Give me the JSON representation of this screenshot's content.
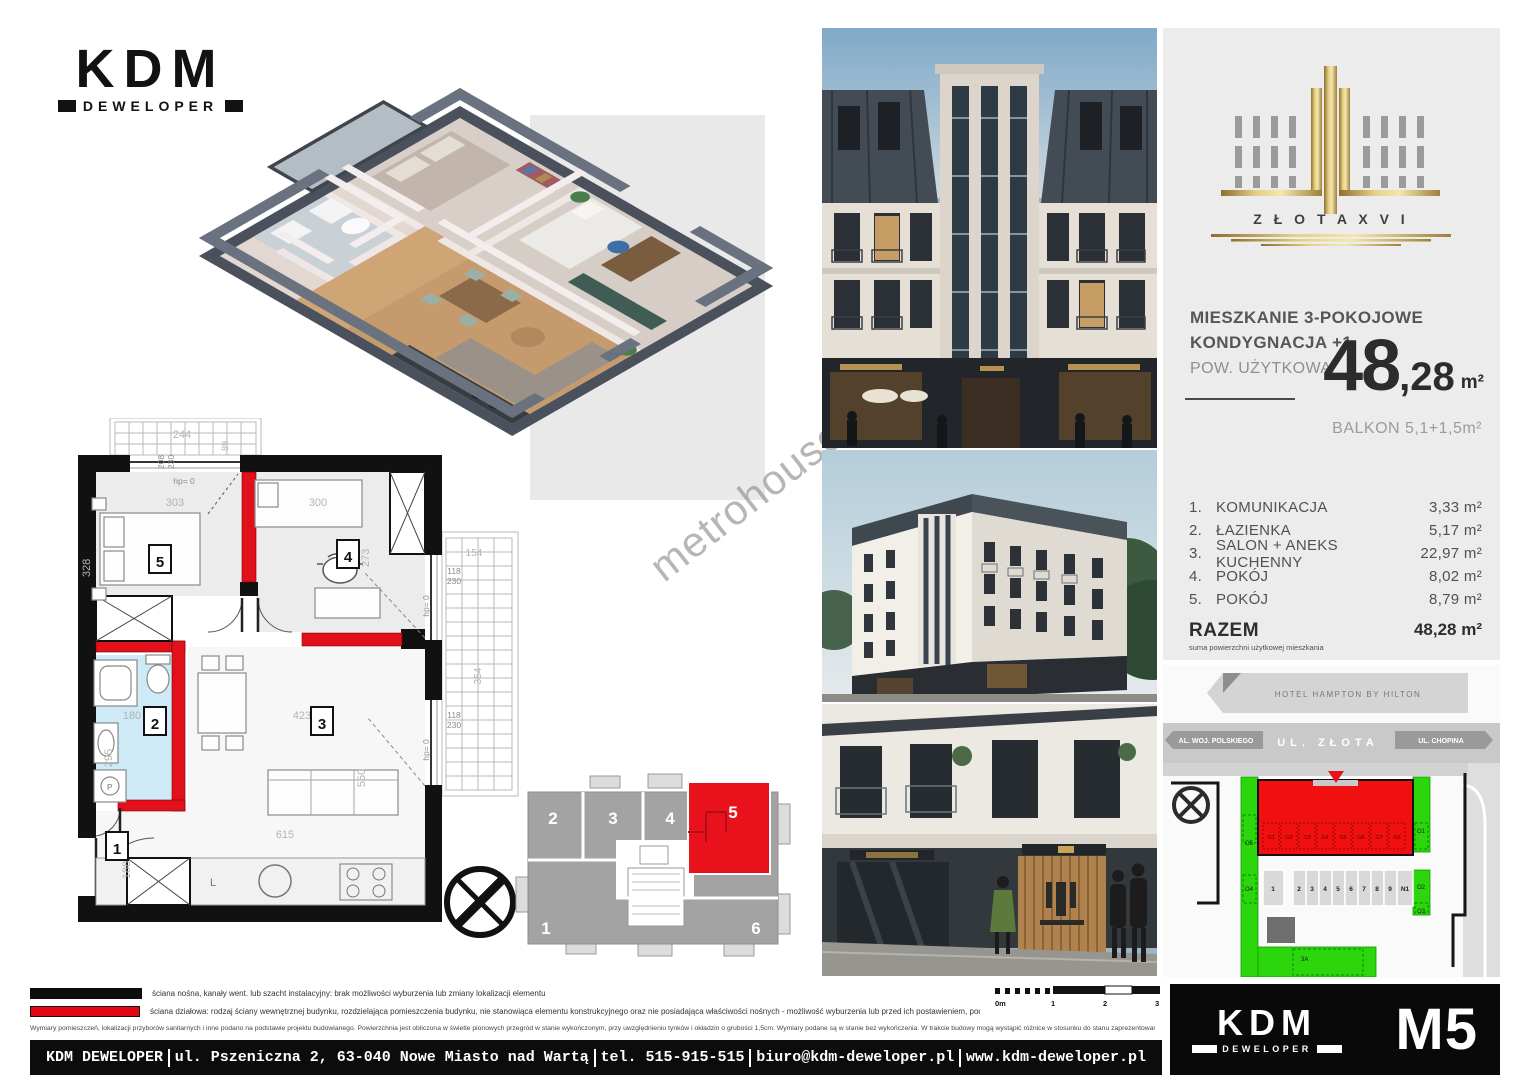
{
  "brand": {
    "logo_text": "KDM",
    "logo_sub": "DEWELOPER"
  },
  "watermark": "metrohouse",
  "project": {
    "name": "Z Ł O T A  X V I"
  },
  "unit": {
    "type_line1": "MIESZKANIE 3-POKOJOWE",
    "type_line2": "KONDYGNACJA +1",
    "area_label": "POW. UŻYTKOWA",
    "area_int": "48",
    "area_dec": ",28",
    "area_unit": "m²",
    "balcony": "BALKON 5,1+1,5m²",
    "rooms": [
      {
        "no": "1.",
        "name": "KOMUNIKACJA",
        "area": "3,33 m²"
      },
      {
        "no": "2.",
        "name": "ŁAZIENKA",
        "area": "5,17 m²"
      },
      {
        "no": "3.",
        "name": "SALON + ANEKS KUCHENNY",
        "area": "22,97 m²"
      },
      {
        "no": "4.",
        "name": "POKÓJ",
        "area": "8,02 m²"
      },
      {
        "no": "5.",
        "name": "POKÓJ",
        "area": "8,79 m²"
      }
    ],
    "total_label": "RAZEM",
    "total_sub": "suma powierzchni użytkowej mieszkania",
    "total_area": "48,28 m²",
    "unit_code": "M5"
  },
  "floorplan": {
    "room_numbers": [
      "1",
      "2",
      "3",
      "4",
      "5"
    ],
    "dims": {
      "room5_w": "303",
      "room5_h": "328",
      "room4_w": "300",
      "room4_h": "273",
      "bath_w": "180",
      "bath_h": "295",
      "salon_w": "423",
      "salon_h": "550",
      "bottom": "615",
      "hall_h": "188",
      "balcony_w": "244",
      "balcony_d": "89",
      "win_top_a": "208",
      "win_top_b": "230",
      "win_r1a": "118",
      "win_r1b": "230",
      "win_r2a": "118",
      "win_r2b": "230",
      "balc_r_w": "154",
      "balc_r_h": "354",
      "hp": "hp= 0",
      "l_label": "L"
    }
  },
  "keyplan": {
    "units": [
      "1",
      "2",
      "3",
      "4",
      "5",
      "6"
    ]
  },
  "sitemap": {
    "hotel": "HOTEL HAMPTON BY HILTON",
    "street_left": "AL. WOJ. POLSKIEGO",
    "street_center": "UL. ZŁOTA",
    "street_right": "UL. CHOPINA",
    "garages": [
      "G1",
      "G2",
      "G3",
      "G4",
      "G5",
      "G6",
      "G7",
      "G8"
    ],
    "parking": [
      "1",
      "2",
      "3",
      "4",
      "5",
      "6",
      "7",
      "8",
      "9",
      "N1"
    ],
    "labels": {
      "o1": "O1",
      "o2": "O2",
      "o3": "O3",
      "o4": "O4",
      "o5": "O5",
      "a3": "3A"
    }
  },
  "legend": {
    "line1": "ściana nośna, kanały went. lub szacht instalacyjny: brak możliwości wyburzenia lub zmiany lokalizacji elementu",
    "line2": "ściana działowa: rodzaj ściany wewnętrznej budynku, rozdzielająca pomieszczenia budynku, nie stanowiąca elementu konstrukcyjnego oraz nie posiadająca właściwości nośnych - możliwość wyburzenia lub przed ich postawieniem, podania własnych preferencji dotyczących lokalizacji elementu",
    "disclaimer": "Wymiary pomieszczeń, lokalizacji przyborów sanitarnych i inne podano na podstawie projektu budowlanego. Powierzchnia jest obliczona w świetle pionowych przegród w stanie wykończonym, przy uwzględnieniu tynków i okładzin o grubości 1,5cm. Wymiary podane są w stanie bez wykończenia. W trakcie budowy mogą wystąpić różnice w stosunku do stanu zaprezentowanego w projekcie, wynikające ze specyfiki prac budowlanych. Powyższa oferta ma charakter informacyjny i nie stanowi oferty handlowej w rozumieniu art. 66 §1 Kodeksu Cywilnego",
    "scale_labels": [
      "0m",
      "1",
      "2",
      "3"
    ]
  },
  "footer": {
    "company": "KDM DEWELOPER",
    "address": "ul. Pszeniczna 2, 63-040 Nowe Miasto nad Wartą",
    "phone": "tel. 515-915-515",
    "email": "biuro@kdm-deweloper.pl",
    "website": "www.kdm-deweloper.pl"
  }
}
